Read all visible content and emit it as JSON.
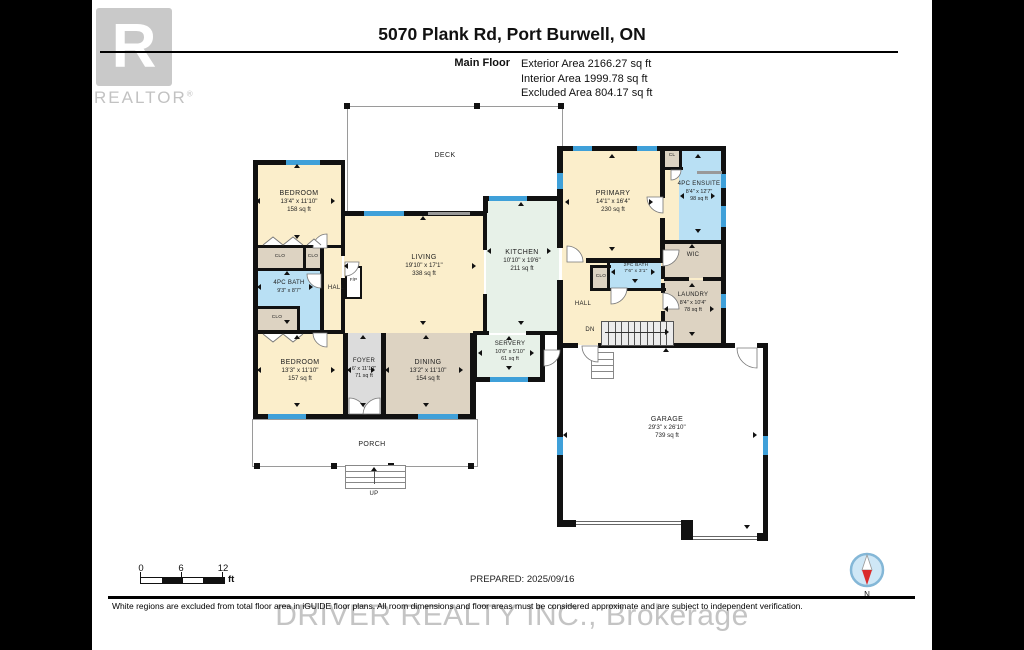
{
  "header": {
    "logo_letter": "R",
    "logo_text": "REALTOR",
    "logo_reg_mark": "®",
    "title": "5070 Plank Rd, Port Burwell, ON",
    "floor_label": "Main Floor",
    "area_lines": [
      "Exterior Area 2166.27 sq ft",
      "Interior Area 1999.78 sq ft",
      "Excluded Area 804.17 sq ft"
    ]
  },
  "rooms": {
    "deck": {
      "name": "DECK"
    },
    "porch": {
      "name": "PORCH"
    },
    "bedroom1": {
      "name": "BEDROOM",
      "dims": "13'4\" x 11'10\"",
      "area": "158 sq ft"
    },
    "clo1": {
      "name": "CLO"
    },
    "clo2": {
      "name": "CLO"
    },
    "clo3": {
      "name": "CLO"
    },
    "clo4": {
      "name": "CLO"
    },
    "bath1": {
      "name": "4PC BATH",
      "dims": "9'3\" x 8'7\""
    },
    "hall1": {
      "name": "HALL"
    },
    "fp": {
      "name": "F/P"
    },
    "bedroom2": {
      "name": "BEDROOM",
      "dims": "13'3\" x 11'10\"",
      "area": "157 sq ft"
    },
    "foyer": {
      "name": "FOYER",
      "dims": "6' x 11'10\"",
      "area": "71 sq ft"
    },
    "dining": {
      "name": "DINING",
      "dims": "13'2\" x 11'10\"",
      "area": "154 sq ft"
    },
    "living": {
      "name": "LIVING",
      "dims": "19'10\" x 17'1\"",
      "area": "338 sq ft"
    },
    "kitchen": {
      "name": "KITCHEN",
      "dims": "10'10\" x 19'6\"",
      "area": "211 sq ft"
    },
    "servery": {
      "name": "SERVERY",
      "dims": "10'6\" x 5'10\"",
      "area": "61 sq ft"
    },
    "primary": {
      "name": "PRIMARY",
      "dims": "14'1\" x 16'4\"",
      "area": "230 sq ft"
    },
    "cl": {
      "name": "CL"
    },
    "ensuite": {
      "name": "4PC ENSUITE",
      "dims": "8'4\" x 12'7\"",
      "area": "98 sq ft"
    },
    "wic": {
      "name": "WIC"
    },
    "bath2": {
      "name": "2PC BATH",
      "dims": "7'6\" x 3'1\""
    },
    "laundry": {
      "name": "LAUNDRY",
      "dims": "8'4\" x 10'4\"",
      "area": "78 sq ft"
    },
    "hall2": {
      "name": "HALL"
    },
    "garage": {
      "name": "GARAGE",
      "dims": "29'3\" x 26'10\"",
      "area": "739 sq ft"
    }
  },
  "labels": {
    "up": "UP",
    "dn": "DN"
  },
  "scale_bar": {
    "ticks": [
      "0",
      "6",
      "12"
    ],
    "unit": "ft"
  },
  "prepared": "PREPARED: 2025/09/16",
  "compass": {
    "north_label": "N"
  },
  "footer": {
    "disclaimer": "White regions are excluded from total floor area in iGUIDE floor plans. All room dimensions and floor areas must be considered approximate and are subject to independent verification.",
    "watermark": "DRIVER REALTY INC., Brokerage"
  },
  "colors": {
    "cream": "#fbeecb",
    "tan": "#ddd3c2",
    "blue": "#b9e0f4",
    "mint": "#e7f1e8",
    "gray": "#dcdcdc",
    "wall": "#111111",
    "window": "#3fa0d9"
  }
}
